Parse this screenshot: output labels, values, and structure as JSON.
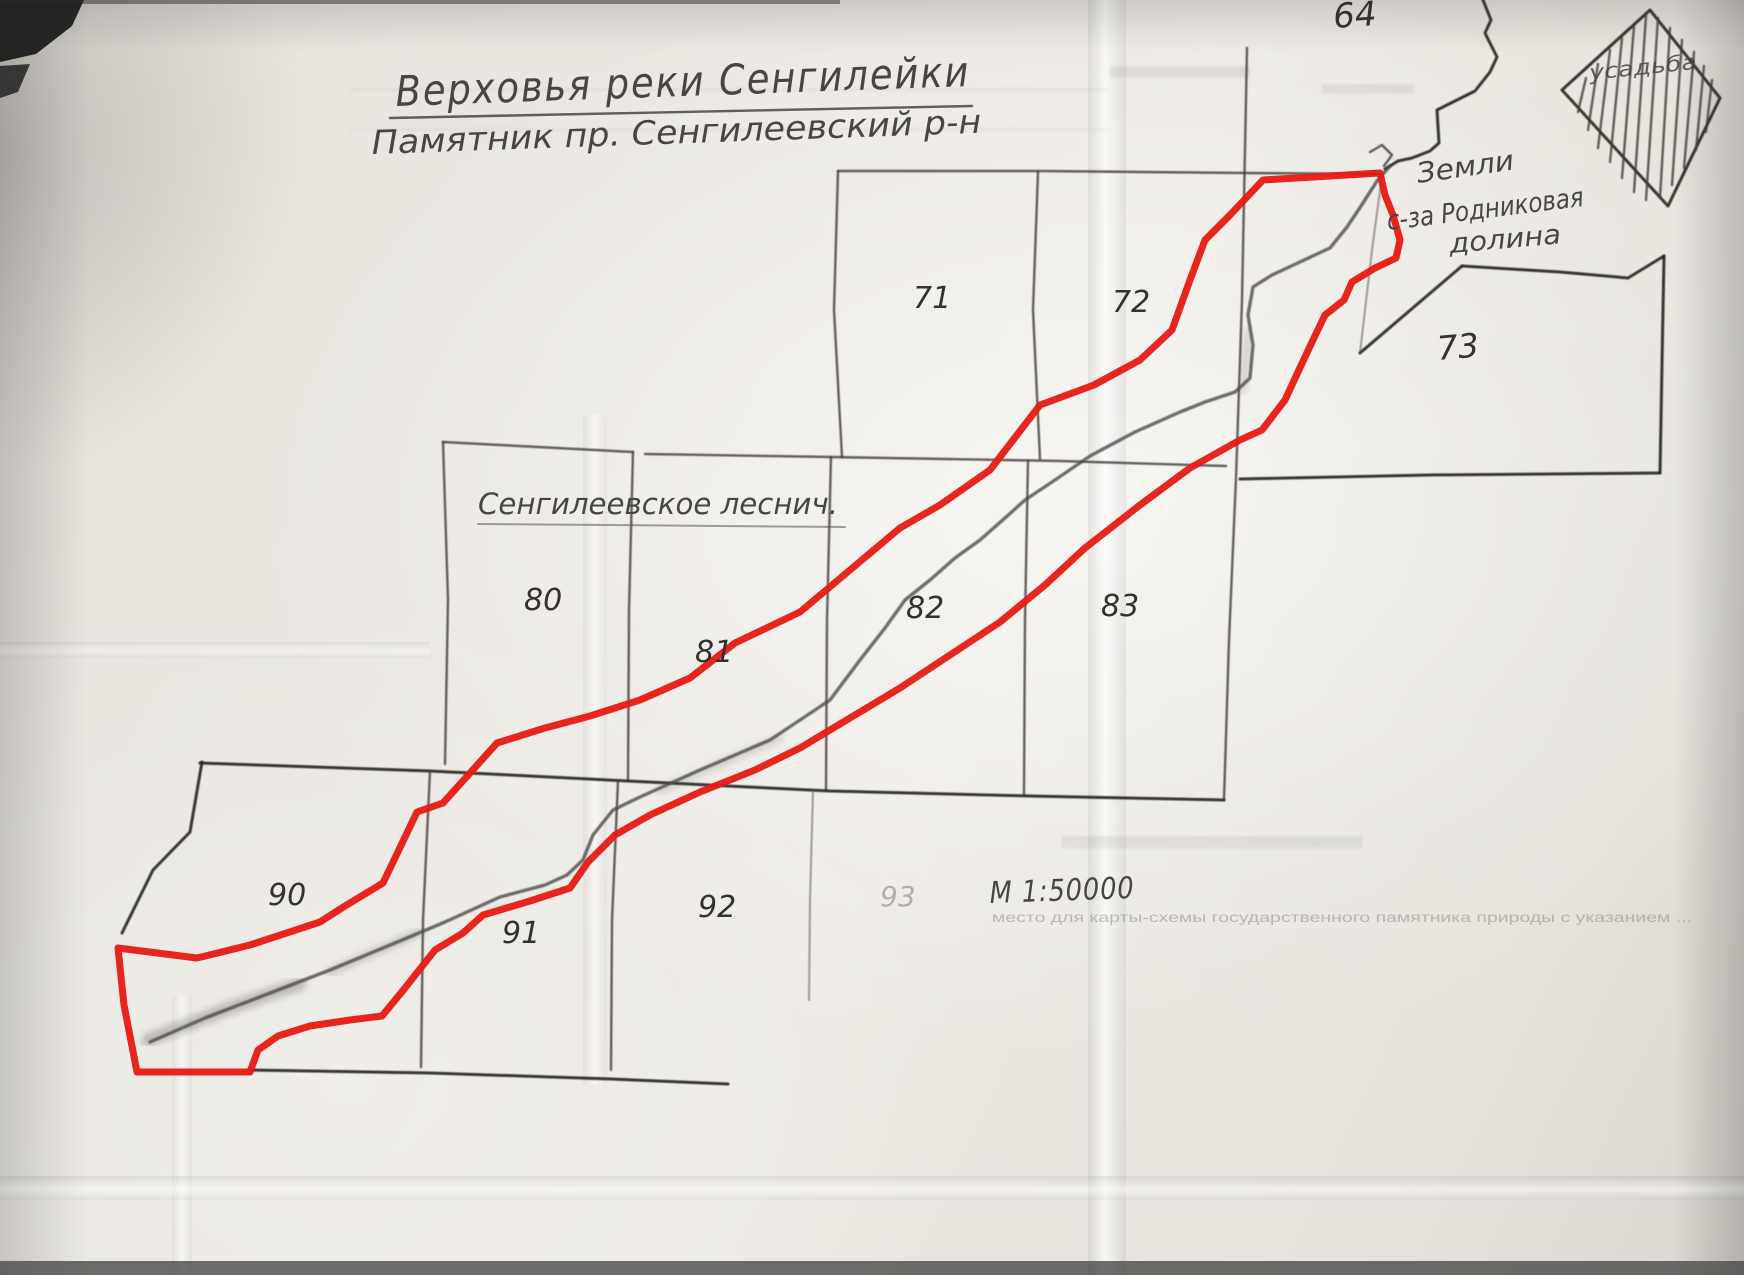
{
  "map": {
    "title": {
      "line1": "Верховья реки Сенгилейки",
      "line2": "Памятник пр.  Сенгилеевский р-н"
    },
    "labels": {
      "forestry": "Сенгилеевское леснич.",
      "lands_line1": "Земли",
      "lands_line2": "с-за Родниковая",
      "lands_line3": "долина",
      "diamond": "усадьба",
      "scale": "М 1:50000",
      "footer_note": "место для карты-схемы государственного памятника природы с указанием ..."
    },
    "quadrants": {
      "q64": "64",
      "q71": "71",
      "q72": "72",
      "q73": "73",
      "q80": "80",
      "q81": "81",
      "q82": "82",
      "q83": "83",
      "q90": "90",
      "q91": "91",
      "q92": "92",
      "q93": "93"
    },
    "colors": {
      "boundary_red": "#e71912",
      "pencil_gray": "#3d3b38",
      "paper": "#e9e6e0"
    }
  }
}
